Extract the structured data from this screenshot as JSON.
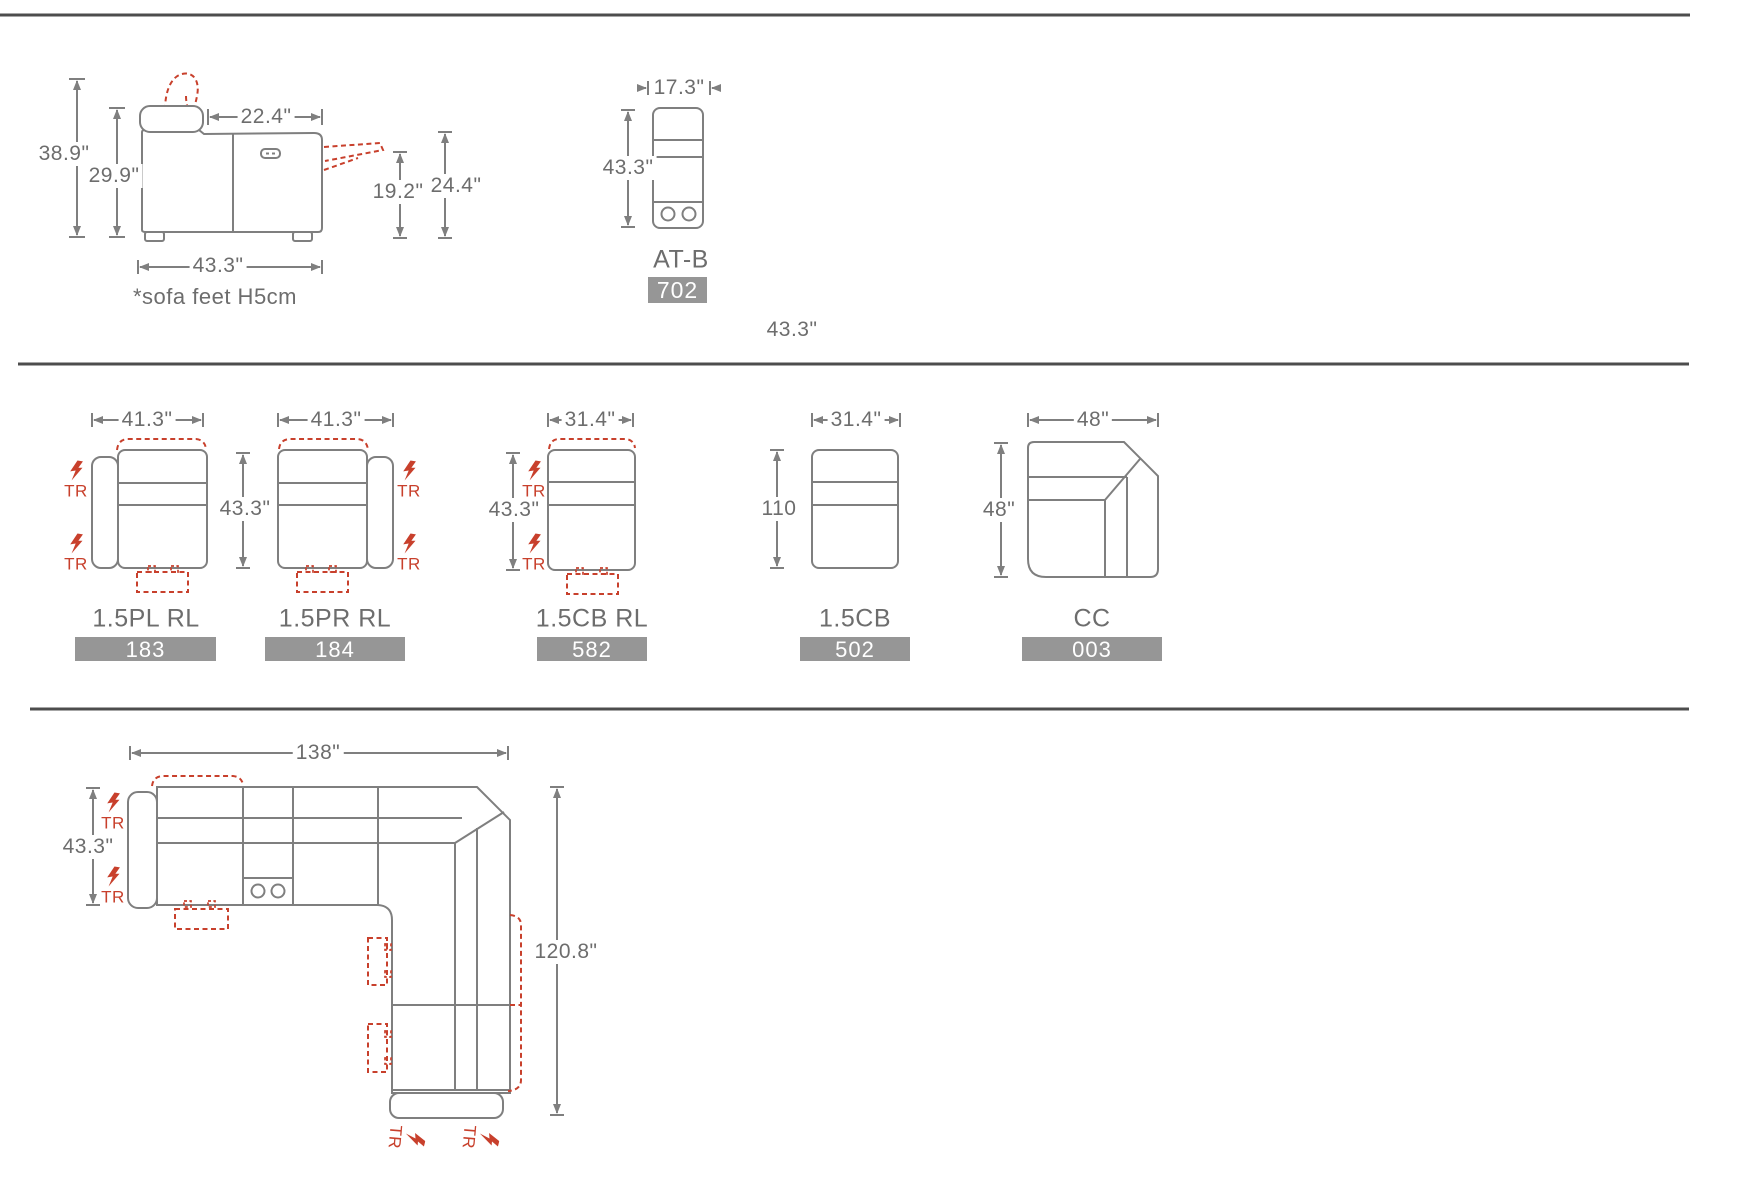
{
  "colors": {
    "line": "#7f7f7f",
    "text": "#6d6d6d",
    "accent_red": "#c8402c",
    "badge_bg": "#969696",
    "badge_text": "#ffffff",
    "divider": "#4d4d4d"
  },
  "tr_label": "TR",
  "side_view": {
    "overall_height": "38.9\"",
    "back_height": "29.9\"",
    "seat_depth": "22.4\"",
    "footrest_height": "19.2\"",
    "footrest_top_height": "24.4\"",
    "overall_depth": "43.3\"",
    "note": "*sofa feet H5cm"
  },
  "console_top": {
    "width": "17.3\"",
    "depth": "43.3\"",
    "label": "AT-B",
    "code": "702"
  },
  "loose_dim": "43.3\"",
  "modules": [
    {
      "label": "1.5PL RL",
      "code": "183",
      "width": "41.3\"",
      "depth": "43.3\""
    },
    {
      "label": "1.5PR RL",
      "code": "184",
      "width": "41.3\""
    },
    {
      "label": "1.5CB RL",
      "code": "582",
      "width": "31.4\"",
      "depth": "43.3\""
    },
    {
      "label": "1.5CB",
      "code": "502",
      "width": "31.4\"",
      "depth": "110"
    },
    {
      "label": "CC",
      "code": "003",
      "width": "48\"",
      "depth": "48\""
    }
  ],
  "sectional": {
    "overall_width": "138\"",
    "depth": "43.3\"",
    "overall_length": "120.8\""
  }
}
